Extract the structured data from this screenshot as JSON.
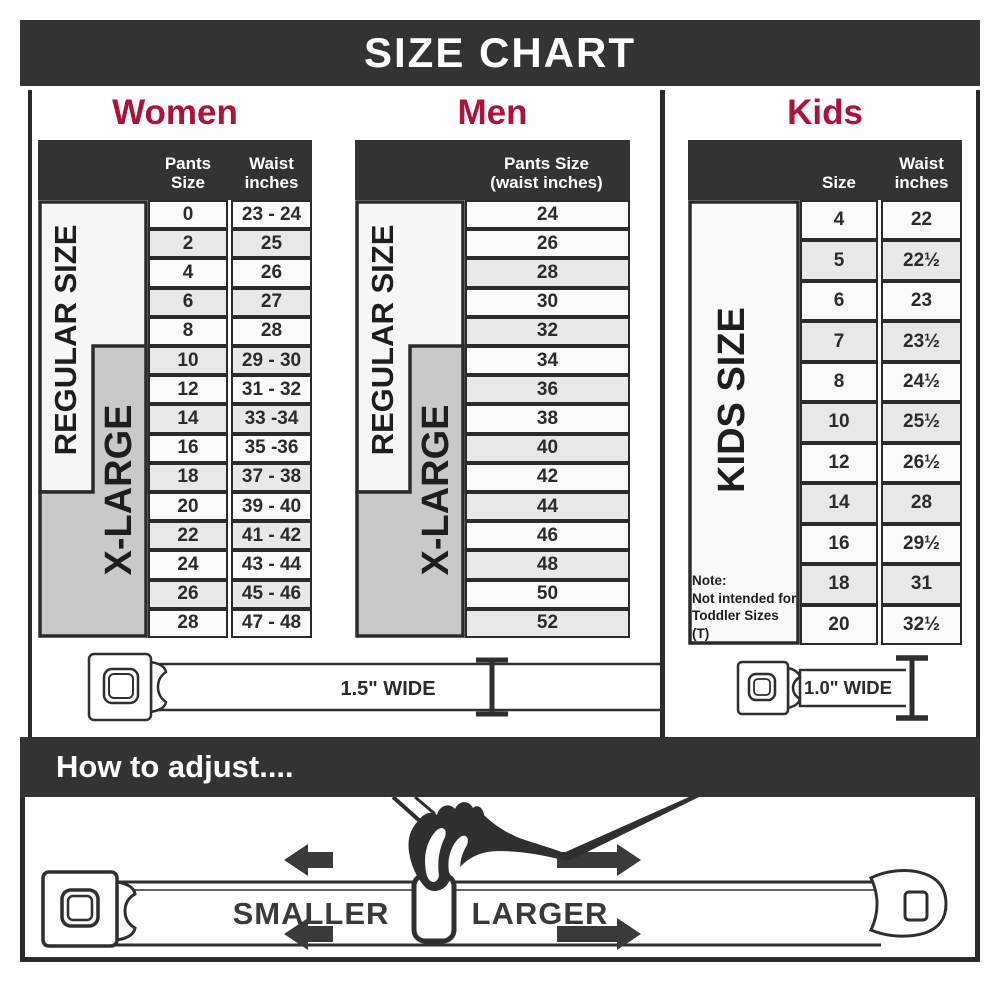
{
  "title": "SIZE CHART",
  "women": {
    "label": "Women",
    "col1_header": "Pants Size",
    "col2_header": "Waist\ninches",
    "band_regular": "REGULAR SIZE",
    "band_xlarge": "X-LARGE",
    "rows": [
      {
        "size": "0",
        "waist": "23 - 24"
      },
      {
        "size": "2",
        "waist": "25"
      },
      {
        "size": "4",
        "waist": "26"
      },
      {
        "size": "6",
        "waist": "27"
      },
      {
        "size": "8",
        "waist": "28"
      },
      {
        "size": "10",
        "waist": "29 - 30"
      },
      {
        "size": "12",
        "waist": "31 - 32"
      },
      {
        "size": "14",
        "waist": "33 -34"
      },
      {
        "size": "16",
        "waist": "35 -36"
      },
      {
        "size": "18",
        "waist": "37 - 38"
      },
      {
        "size": "20",
        "waist": "39 - 40"
      },
      {
        "size": "22",
        "waist": "41 - 42"
      },
      {
        "size": "24",
        "waist": "43 - 44"
      },
      {
        "size": "26",
        "waist": "45 - 46"
      },
      {
        "size": "28",
        "waist": "47 - 48"
      }
    ],
    "belt_width_label": "1.5\" WIDE"
  },
  "men": {
    "label": "Men",
    "col_header": "Pants Size\n(waist inches)",
    "band_regular": "REGULAR SIZE",
    "band_xlarge": "X-LARGE",
    "rows": [
      "24",
      "26",
      "28",
      "30",
      "32",
      "34",
      "36",
      "38",
      "40",
      "42",
      "44",
      "46",
      "48",
      "50",
      "52"
    ]
  },
  "kids": {
    "label": "Kids",
    "col1_header": "Size",
    "col2_header": "Waist\ninches",
    "band": "KIDS SIZE",
    "note": "Note:\nNot intended for\nToddler Sizes (T)",
    "rows": [
      {
        "size": "4",
        "waist": "22"
      },
      {
        "size": "5",
        "waist": "22½"
      },
      {
        "size": "6",
        "waist": "23"
      },
      {
        "size": "7",
        "waist": "23½"
      },
      {
        "size": "8",
        "waist": "24½"
      },
      {
        "size": "10",
        "waist": "25½"
      },
      {
        "size": "12",
        "waist": "26½"
      },
      {
        "size": "14",
        "waist": "28"
      },
      {
        "size": "16",
        "waist": "29½"
      },
      {
        "size": "18",
        "waist": "31"
      },
      {
        "size": "20",
        "waist": "32½"
      }
    ],
    "belt_width_label": "1.0\" WIDE"
  },
  "adjust": {
    "heading": "How to adjust....",
    "smaller": "SMALLER",
    "larger": "LARGER"
  },
  "colors": {
    "accent": "#AC1339",
    "header_dark": "#333333",
    "row_light": "#FAFAFA",
    "row_shaded": "#E8E8E8",
    "xlarge_gray": "#C9C9C9",
    "outline": "#2B2B2B"
  }
}
